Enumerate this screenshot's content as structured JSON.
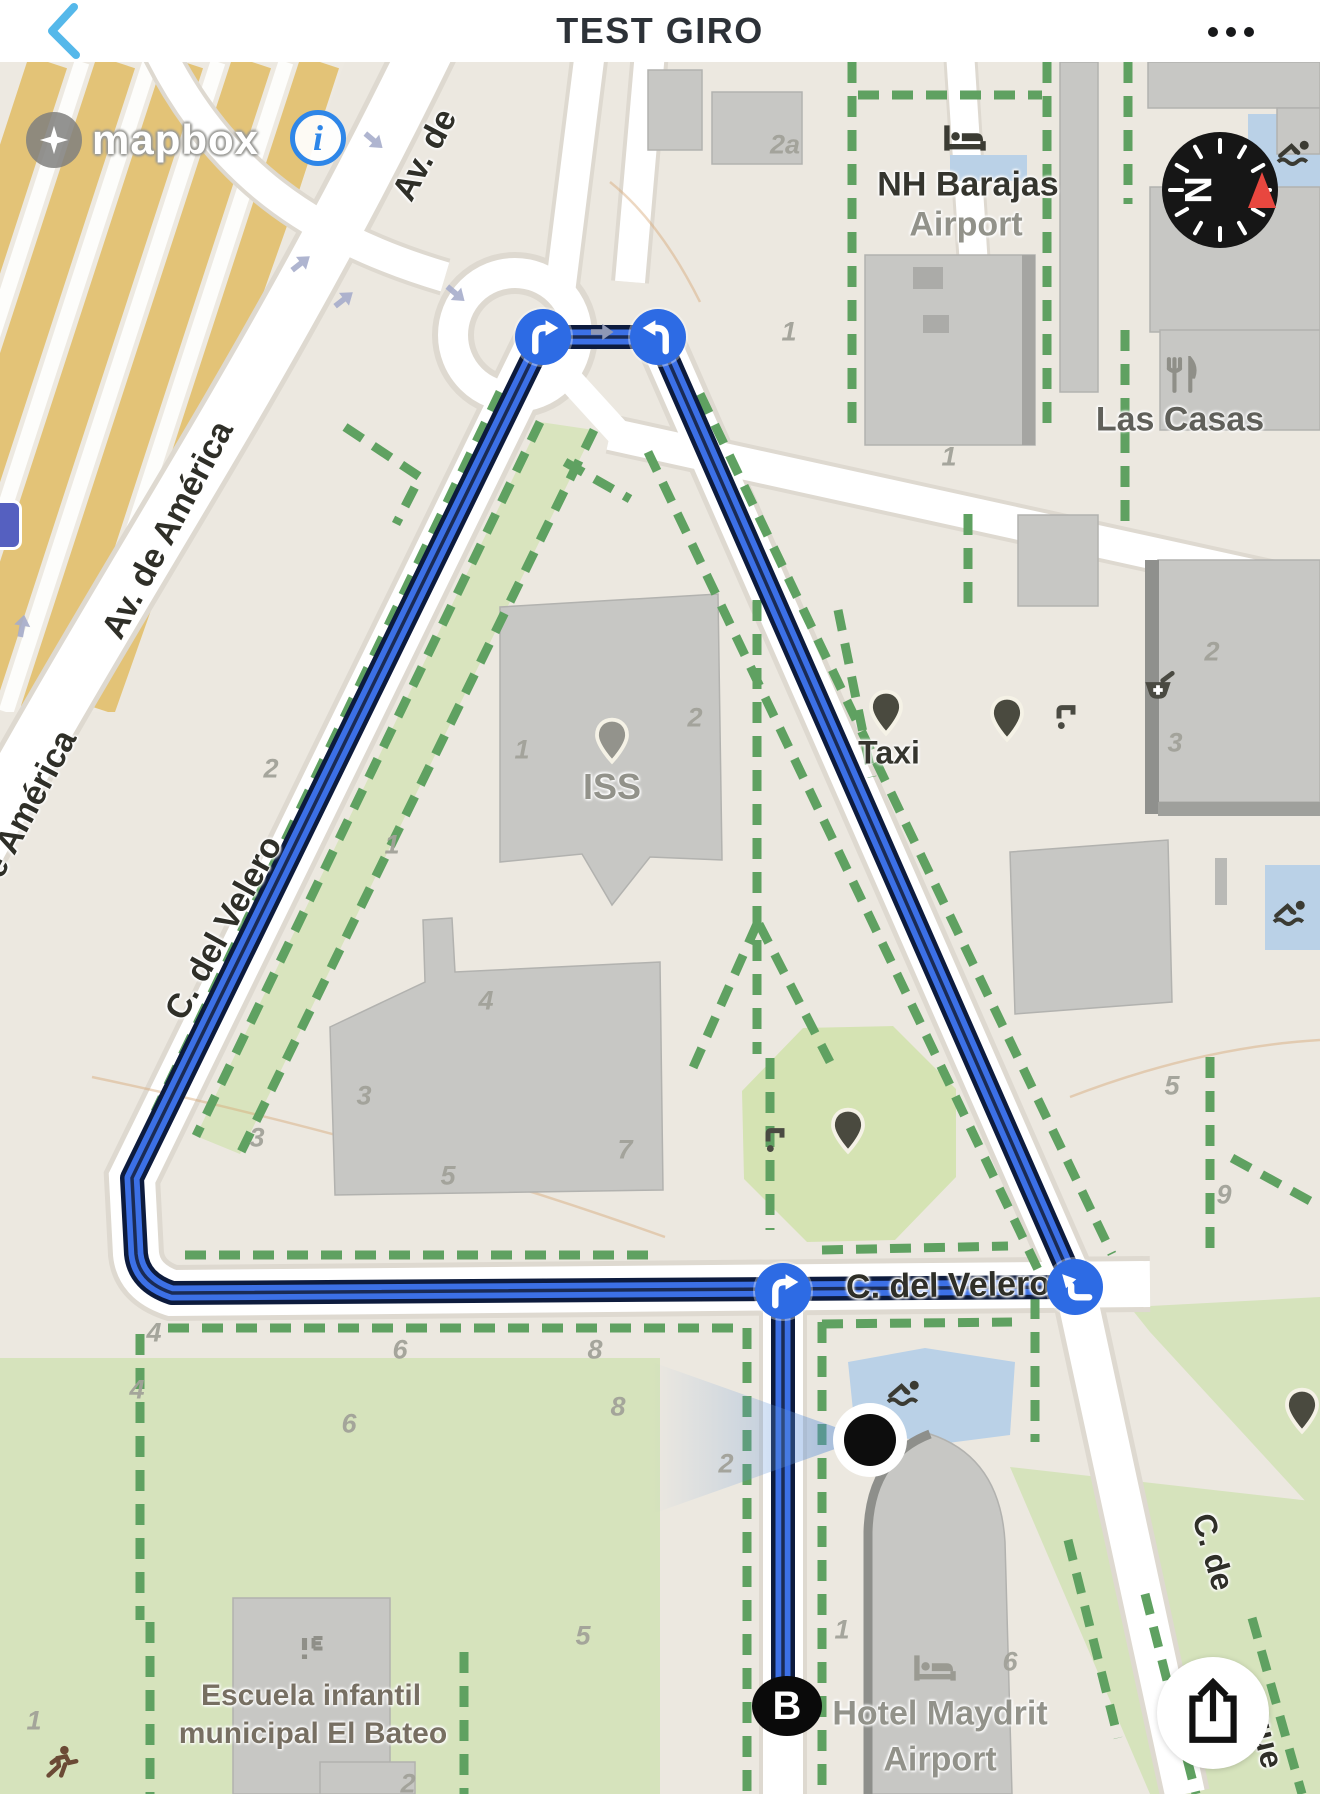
{
  "header": {
    "title": "TEST GIRO"
  },
  "attribution": {
    "brand": "mapbox",
    "info": "i"
  },
  "compass": {
    "letter": "N"
  },
  "end_marker": {
    "label": "B"
  },
  "colors": {
    "route_blue": "#3C70E6",
    "route_casing": "#0D1B3D",
    "route_centerline": "#1A2B55",
    "marker_blue": "#2D6BE4",
    "back_chevron": "#55B8EA",
    "info_accent": "#2E86E8",
    "compass_red": "#E8473F",
    "green_path": "#5FA161",
    "water": "#BAD1E7",
    "highway": "#E3C377"
  },
  "street_labels": [
    {
      "text": "Av. de",
      "x": 425,
      "y": 93,
      "rot": -62,
      "size": 34
    },
    {
      "text": "Av. de América",
      "x": 168,
      "y": 468,
      "rot": -62,
      "size": 34
    },
    {
      "text": "e América",
      "x": 30,
      "y": 742,
      "rot": -62,
      "size": 34
    },
    {
      "text": "C. del Velero",
      "x": 224,
      "y": 866,
      "rot": -61,
      "size": 34
    },
    {
      "text": "C. del Velero",
      "x": 948,
      "y": 1224,
      "rot": -1,
      "size": 34
    },
    {
      "text": "C. de",
      "x": 1213,
      "y": 1490,
      "rot": 74,
      "size": 32
    },
    {
      "text": "que",
      "x": 1266,
      "y": 1678,
      "rot": 76,
      "size": 32
    }
  ],
  "place_labels": [
    {
      "text": "NH Barajas",
      "x": 968,
      "y": 123,
      "cls": "dark",
      "size": 34
    },
    {
      "text": "Airport",
      "x": 966,
      "y": 163,
      "cls": "gray",
      "size": 34
    },
    {
      "text": "Las Casas",
      "x": 1180,
      "y": 358,
      "cls": "mid",
      "size": 34
    },
    {
      "text": "ISS",
      "x": 612,
      "y": 725,
      "cls": "gray",
      "size": 36
    },
    {
      "text": "Taxi",
      "x": 889,
      "y": 691,
      "cls": "dark",
      "size": 32
    },
    {
      "text": "Hotel Maydrit",
      "x": 940,
      "y": 1652,
      "cls": "gray",
      "size": 34
    },
    {
      "text": "Airport",
      "x": 940,
      "y": 1698,
      "cls": "gray",
      "size": 34
    },
    {
      "text": "Escuela infantil",
      "x": 311,
      "y": 1634,
      "cls": "brown",
      "size": 30
    },
    {
      "text": "municipal El Bateo",
      "x": 313,
      "y": 1672,
      "cls": "brown",
      "size": 30
    }
  ],
  "lot_numbers": [
    {
      "t": "2a",
      "x": 785,
      "y": 83
    },
    {
      "t": "1",
      "x": 789,
      "y": 270
    },
    {
      "t": "1",
      "x": 949,
      "y": 395
    },
    {
      "t": "2",
      "x": 1212,
      "y": 590
    },
    {
      "t": "3",
      "x": 1175,
      "y": 681
    },
    {
      "t": "1",
      "x": 522,
      "y": 688
    },
    {
      "t": "2",
      "x": 695,
      "y": 656
    },
    {
      "t": "2",
      "x": 271,
      "y": 707
    },
    {
      "t": "1",
      "x": 392,
      "y": 783
    },
    {
      "t": "3",
      "x": 364,
      "y": 1034
    },
    {
      "t": "4",
      "x": 486,
      "y": 939
    },
    {
      "t": "5",
      "x": 448,
      "y": 1114
    },
    {
      "t": "7",
      "x": 625,
      "y": 1088
    },
    {
      "t": "3",
      "x": 257,
      "y": 1076
    },
    {
      "t": "4",
      "x": 154,
      "y": 1271
    },
    {
      "t": "6",
      "x": 400,
      "y": 1288
    },
    {
      "t": "8",
      "x": 595,
      "y": 1288
    },
    {
      "t": "4",
      "x": 137,
      "y": 1328
    },
    {
      "t": "6",
      "x": 349,
      "y": 1362
    },
    {
      "t": "8",
      "x": 618,
      "y": 1345
    },
    {
      "t": "2",
      "x": 726,
      "y": 1402
    },
    {
      "t": "5",
      "x": 583,
      "y": 1574
    },
    {
      "t": "1",
      "x": 34,
      "y": 1659
    },
    {
      "t": "1",
      "x": 842,
      "y": 1568
    },
    {
      "t": "6",
      "x": 1010,
      "y": 1600
    },
    {
      "t": "5",
      "x": 1172,
      "y": 1024
    },
    {
      "t": "9",
      "x": 1224,
      "y": 1133
    },
    {
      "t": "2",
      "x": 408,
      "y": 1722
    }
  ],
  "pins": [
    {
      "x": 612,
      "y": 690,
      "variant": "light"
    },
    {
      "x": 886,
      "y": 662,
      "variant": "dark"
    },
    {
      "x": 1007,
      "y": 668,
      "variant": "dark"
    },
    {
      "x": 848,
      "y": 1080,
      "variant": "dark"
    },
    {
      "x": 1302,
      "y": 1360,
      "variant": "dark"
    }
  ],
  "pois": [
    {
      "icon": "bed",
      "x": 965,
      "y": 76,
      "color": "#3b3b33"
    },
    {
      "icon": "bed",
      "x": 935,
      "y": 1606,
      "color": "#9a9a92"
    },
    {
      "icon": "restaurant",
      "x": 1180,
      "y": 313,
      "color": "#8f8f88"
    },
    {
      "icon": "pharmacy",
      "x": 1158,
      "y": 628,
      "color": "#4a4a42"
    },
    {
      "icon": "swimmer",
      "x": 1296,
      "y": 90,
      "color": "#3b3b33"
    },
    {
      "icon": "swimmer",
      "x": 1292,
      "y": 850,
      "color": "#3b3b33"
    },
    {
      "icon": "swimmer",
      "x": 906,
      "y": 1330,
      "color": "#3b3b33"
    },
    {
      "icon": "water-tap",
      "x": 1066,
      "y": 655,
      "color": "#4a4a42"
    },
    {
      "icon": "water-tap",
      "x": 775,
      "y": 1078,
      "color": "#4a4a42"
    },
    {
      "icon": "school",
      "x": 312,
      "y": 1588,
      "color": "#8f8f88"
    },
    {
      "icon": "playground",
      "x": 62,
      "y": 1700,
      "color": "#6b4a35"
    }
  ],
  "route_markers": [
    {
      "glyph": "turn-right",
      "x": 543,
      "y": 275
    },
    {
      "glyph": "uturn-left",
      "x": 658,
      "y": 275
    },
    {
      "glyph": "turn-right",
      "x": 783,
      "y": 1229
    },
    {
      "glyph": "sharp-left",
      "x": 1075,
      "y": 1225
    }
  ],
  "direction_arrows": [
    {
      "x": 601,
      "y": 270,
      "rot": 0
    }
  ],
  "oneway_arrows": [
    {
      "x": 373,
      "y": 78,
      "rot": 40
    },
    {
      "x": 455,
      "y": 231,
      "rot": 40
    },
    {
      "x": 300,
      "y": 202,
      "rot": -38
    },
    {
      "x": 343,
      "y": 238,
      "rot": -38
    },
    {
      "x": 22,
      "y": 565,
      "rot": -80
    }
  ]
}
